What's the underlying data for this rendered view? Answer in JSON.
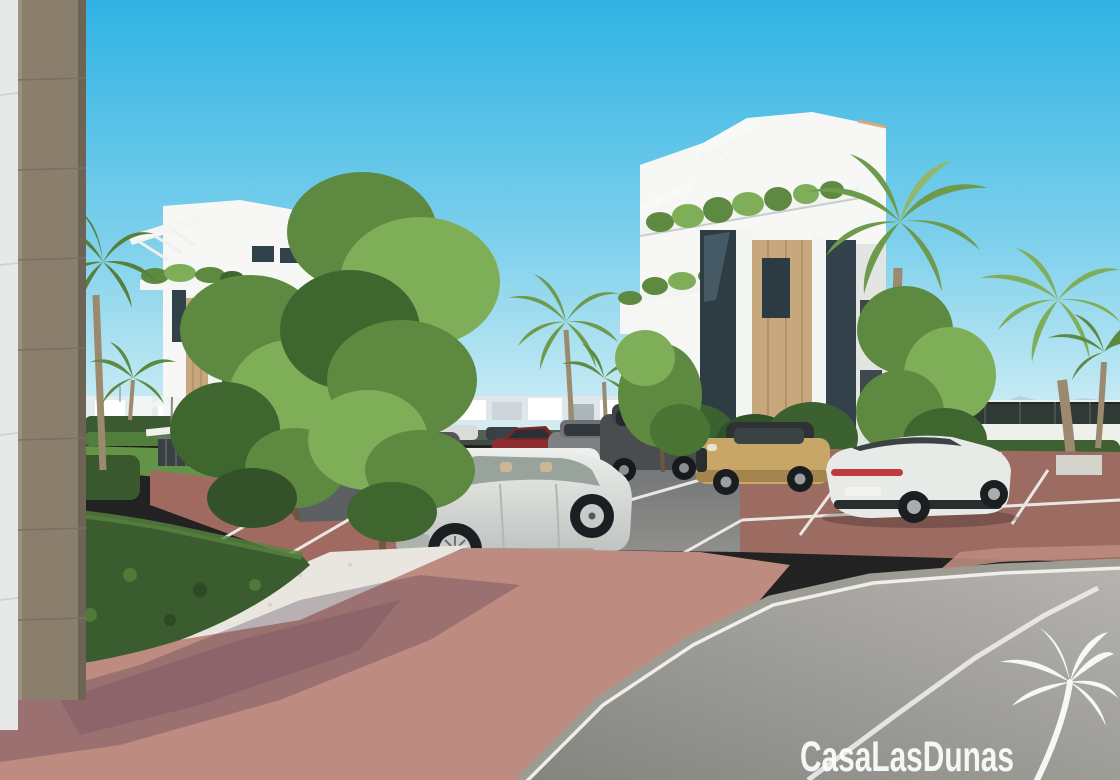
{
  "watermark": {
    "text": "CasaLasDunas",
    "logo_icon": "palm-tree-icon"
  },
  "palette": {
    "sky-top": "#2fb3e3",
    "sky-mid": "#7ed0ec",
    "sky-horizon": "#d8f1f7",
    "building-white": "#f7f8f5",
    "building-shade": "#e2e5e1",
    "wood-panel": "#c7a77c",
    "wood-column": "#8a7e6c",
    "glass-dark": "#31424b",
    "tree-green": "#5d8a40",
    "tree-green-dark": "#3f662f",
    "tree-green-light": "#7fae58",
    "hedge-dark": "#33522a",
    "palm-green": "#6e9a4c",
    "palm-trunk": "#9c8a6e",
    "grass": "#639346",
    "asphalt": "#6e7173",
    "road": "#9a9995",
    "brick": "#bd8b7f",
    "brick-dark": "#9c6b62",
    "gravel": "#e9e6df",
    "line-white": "#efeeea",
    "car-white": "#e8eae7",
    "car-silver": "#dfe1de",
    "car-dark": "#4a4d50",
    "car-gold": "#c7a668",
    "car-red": "#8c2e30",
    "taillight-red": "#c03a3a",
    "watermark-white": "#ffffff"
  }
}
